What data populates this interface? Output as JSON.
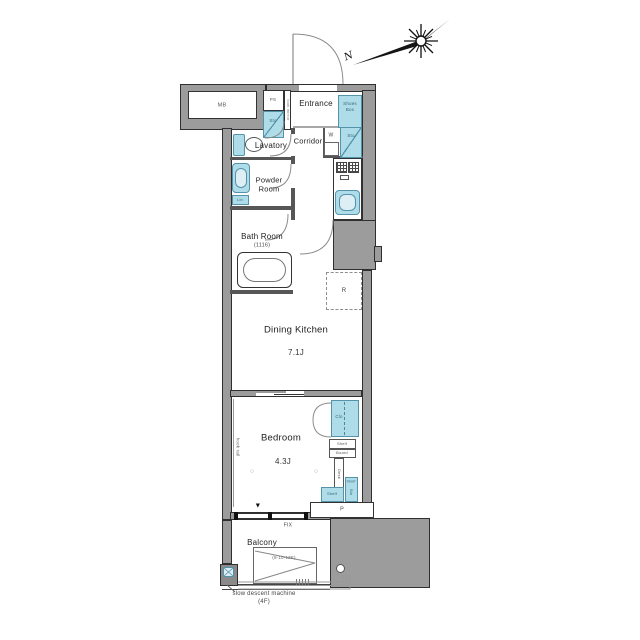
{
  "meta": {
    "type": "apartment-floor-plan"
  },
  "compass": {
    "north": "N"
  },
  "labels": {
    "mb": "MB",
    "ps": "PS",
    "hall_storage": "Sto",
    "entrance": "Entrance",
    "shoes_box_1": "Shoes",
    "shoes_box_2": "Box",
    "mirror": "look mirror",
    "lavatory": "Lavatory",
    "corridor": "Corridor",
    "washer": "W",
    "corridor_storage": "Sto",
    "powder_1": "Powder",
    "powder_2": "Room",
    "linen": "Lin",
    "bath": "Bath Room",
    "bath_size": "(1116)",
    "dining_kitchen": "Dining Kitchen",
    "dining_kitchen_size": "7.1J",
    "refrigerator": "R",
    "bedroom": "Bedroom",
    "bedroom_size": "4.3J",
    "closet": "Clo",
    "shelf_top": "Shelf",
    "board": "Board",
    "desk": "Desk",
    "shelf_bottom": "Shelf",
    "shelf_side": "Shelf",
    "bedroom_storage": "Sto",
    "hook_rail": "hook rail",
    "pipe_space": "P",
    "fix_window": "FIX",
    "balcony": "Balcony",
    "hatch_id": "(8-10-12E)",
    "note_1": "slow descent machine",
    "note_2": "(4F)",
    "vent": "▼",
    "light_marker": "◇"
  },
  "colors": {
    "wall_gray": "#9c9c9c",
    "fixture_blue": "#aedce8",
    "fixture_stroke": "#5593ab",
    "line_dark": "#2f2f2f"
  }
}
